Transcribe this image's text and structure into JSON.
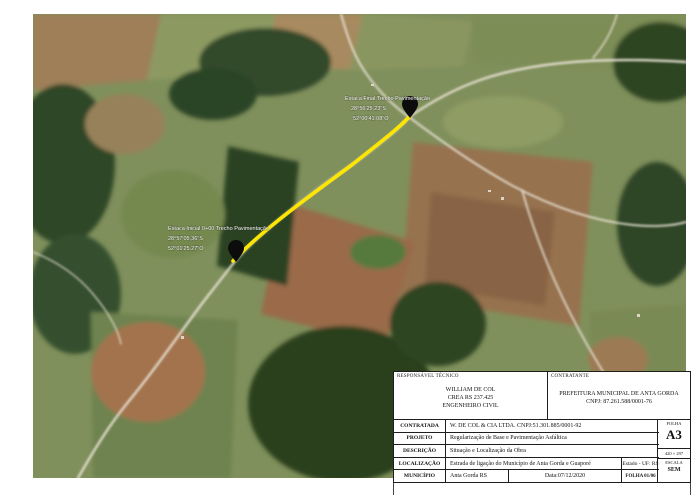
{
  "map": {
    "route_color": "#ffe600",
    "pin_end": {
      "label_lines": [
        "Estaca Final Trecho Pavimentação",
        "28°56'25,23\"S",
        "52°00'41,08\"O"
      ]
    },
    "pin_start": {
      "label_lines": [
        "Estaca Inicial 0+00 Trecho Pavimentação",
        "28°57'05,36\"S",
        "52°01'25,27\"O"
      ]
    }
  },
  "titleblock": {
    "responsavel": {
      "label": "RESPONSÁVEL TÉCNICO",
      "line1": "WILLIAM DE COL",
      "line2": "CREA RS 237.425",
      "line3": "ENGENHEIRO CIVIL"
    },
    "contratante": {
      "label": "CONTRATANTE",
      "line1": "PREFEITURA MUNICIPAL DE ANTA GORDA",
      "line2": "CNPJ: 87.261.588/0001-76"
    },
    "rows": [
      {
        "label": "CONTRATADA",
        "value": "W. DE COL & CIA LTDA. CNPJ:51.301.885/0001-92"
      },
      {
        "label": "PROJETO",
        "value": "Regularização de Base e Pavimentação Asfáltica"
      },
      {
        "label": "DESCRIÇÃO",
        "value": "Situação e Localização da Obra"
      },
      {
        "label": "LOCALIZAÇÃO",
        "value": "Estrada de ligação do Município de Anta Gorda e Guaporé",
        "extra": "Estado - UF: RS"
      },
      {
        "label": "MUNICÍPIO",
        "value": "Anta Gorda RS",
        "date": "Data:07/12/2020",
        "folha": "FOLHA 01/06"
      }
    ],
    "side": {
      "folha_label": "FOLHA",
      "sheet": "A3",
      "size": "420 × 297",
      "escala_label": "ESCALA",
      "escala_value": "SEM"
    }
  }
}
